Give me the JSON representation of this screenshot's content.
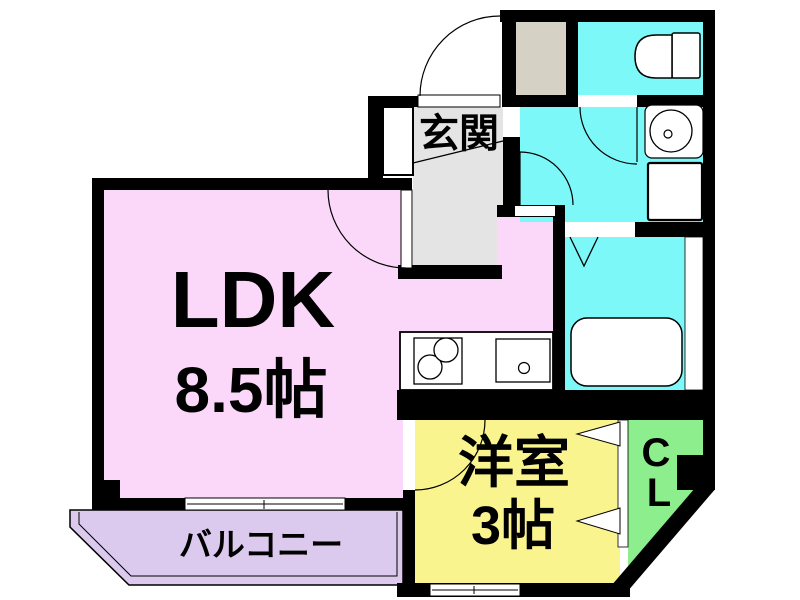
{
  "floorplan": {
    "type": "apartment-floorplan",
    "rooms": {
      "ldk": {
        "label": "LDK",
        "size_label": "8.5帖",
        "color": "#fbd8fa"
      },
      "western_room": {
        "label": "洋室",
        "size_label": "3帖",
        "color": "#faf48f"
      },
      "genkan": {
        "label": "玄関",
        "color": "#e4e4e4"
      },
      "balcony": {
        "label": "バルコニー",
        "color": "#dccaee"
      },
      "closet": {
        "label_line1": "C",
        "label_line2": "L",
        "color": "#8cee8c"
      },
      "toilet_room": {
        "color": "#7df8f8"
      },
      "washroom": {
        "color": "#7df8f8"
      },
      "bathroom": {
        "color": "#7df8f8"
      },
      "shoe_storage": {
        "color": "#d5d1c4"
      }
    },
    "fixtures": [
      "entrance-door",
      "shoe-cabinet",
      "toilet",
      "washbasin",
      "washing-machine-pan",
      "bathtub",
      "kitchen-stove",
      "kitchen-sink",
      "sliding-window",
      "closet-bifold-door",
      "bath-folding-door"
    ],
    "wall_color": "#000000",
    "line_color": "#000000"
  }
}
